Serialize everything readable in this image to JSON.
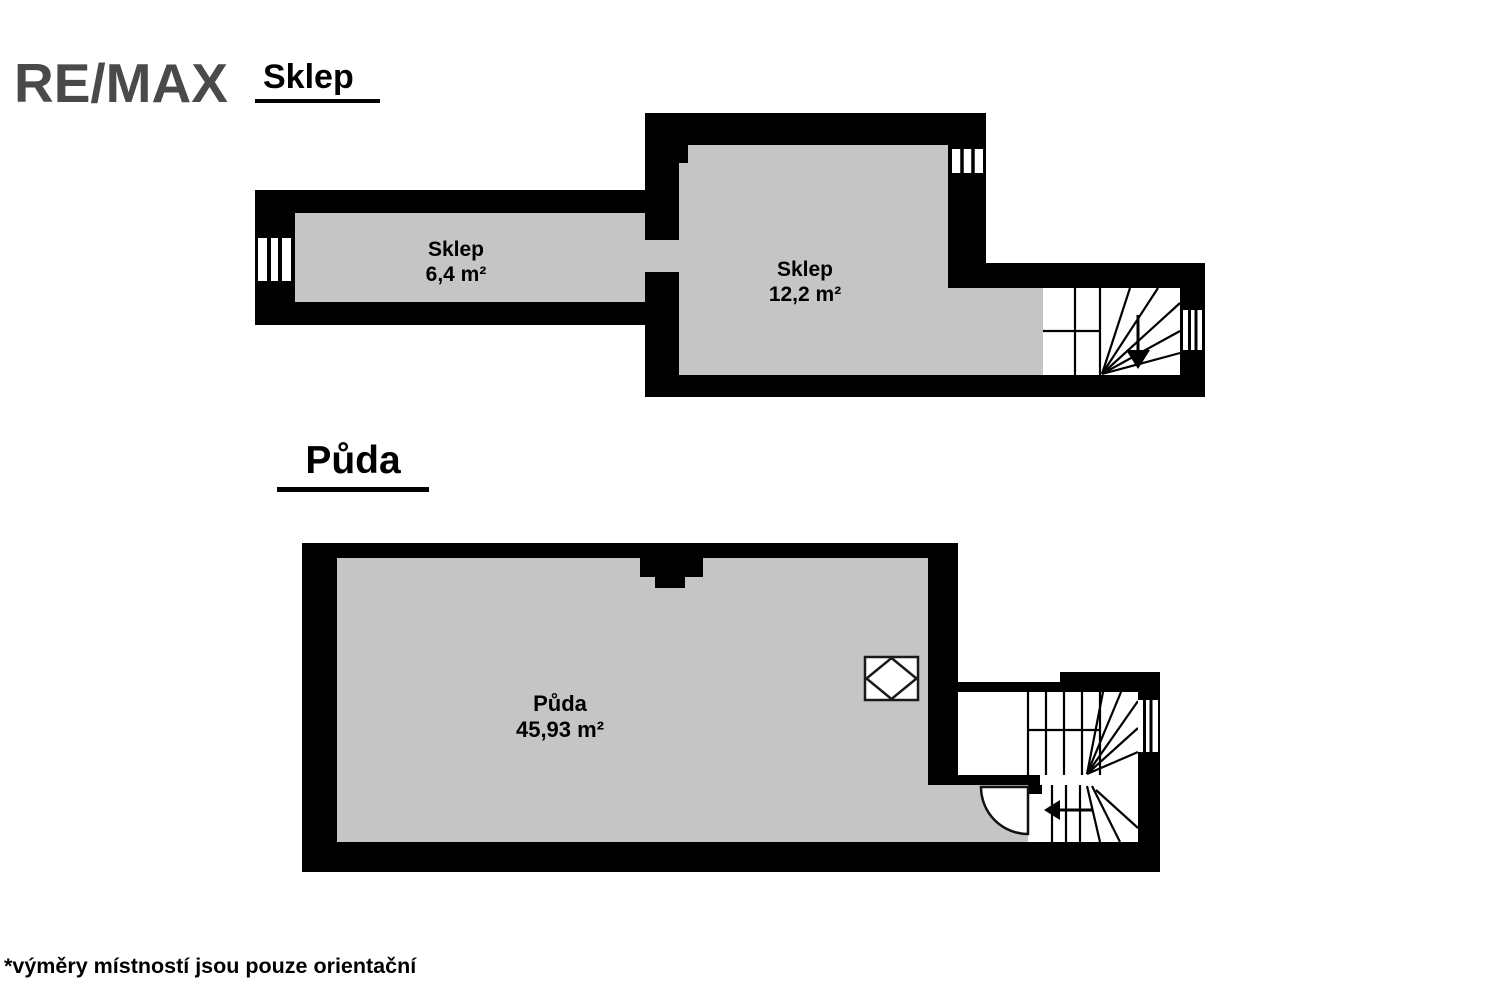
{
  "logo": {
    "text": "RE/MAX",
    "color": "#4a4a4a"
  },
  "floors": [
    {
      "id": "sklep",
      "title": "Sklep",
      "rooms": [
        {
          "name": "Sklep",
          "area": "6,4 m²"
        },
        {
          "name": "Sklep",
          "area": "12,2 m²"
        }
      ]
    },
    {
      "id": "puda",
      "title": "Půda",
      "rooms": [
        {
          "name": "Půda",
          "area": "45,93 m²"
        }
      ]
    }
  ],
  "footnote": "*výměry místností jsou pouze orientační",
  "colors": {
    "wall": "#000000",
    "floor_fill": "#c5c5c5",
    "stair_fill": "#ffffff",
    "logo_gray": "#4a4a4a"
  }
}
